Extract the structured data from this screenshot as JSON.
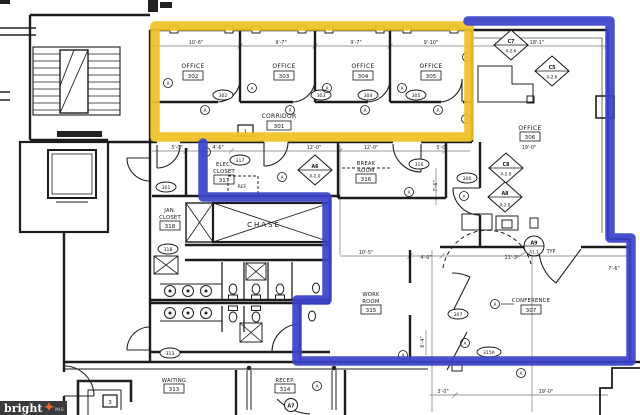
{
  "colors": {
    "highlight_yellow": "#EFC226",
    "highlight_blue": "#3B43C9",
    "ink": "#1c1c1c",
    "watermark_bg": "#3a3a3c",
    "watermark_accent": "#E8622D"
  },
  "watermark": {
    "brand": "bright",
    "suffix": "MLS"
  },
  "rooms": {
    "office_302": {
      "name": "OFFICE",
      "num": "302"
    },
    "office_303": {
      "name": "OFFICE",
      "num": "303"
    },
    "office_304": {
      "name": "OFFICE",
      "num": "304"
    },
    "office_305": {
      "name": "OFFICE",
      "num": "305"
    },
    "corridor_301": {
      "name": "CORRIDOR",
      "num": "301"
    },
    "office_306": {
      "name": "OFFICE",
      "num": "306"
    },
    "elec_closet_317": {
      "name1": "ELEC.",
      "name2": "CLOSET",
      "num": "317"
    },
    "break_room_316": {
      "name1": "BREAK",
      "name2": "ROOM",
      "num": "316"
    },
    "jan_closet_318": {
      "name1": "JAN.",
      "name2": "CLOSET",
      "num": "318"
    },
    "chase": {
      "name": "CHASE"
    },
    "work_room_315": {
      "name1": "WORK",
      "name2": "ROOM",
      "num": "315"
    },
    "conference_307": {
      "name": "CONFERENCE",
      "num": "307"
    },
    "waiting_313": {
      "name": "WAITING",
      "num": "313"
    },
    "recep_314": {
      "name": "RECEP.",
      "num": "314"
    }
  },
  "door_tags": {
    "t301": "301",
    "t302": "302",
    "t303": "303",
    "t304": "304",
    "t305": "305",
    "t306": "306",
    "t307": "307",
    "t313": "313",
    "t315a": "315A",
    "t316": "316",
    "t317": "317",
    "t318": "318"
  },
  "detail_markers": {
    "c7": {
      "code": "C7",
      "sheet": "A-2.6"
    },
    "c5": {
      "code": "C5",
      "sheet": "A-2.6"
    },
    "c8": {
      "code": "C8",
      "sheet": "A-2.0"
    },
    "a6": {
      "code": "A6",
      "sheet": "A-2.0"
    },
    "a8": {
      "code": "A8",
      "sheet": "A-2.0"
    },
    "a9": {
      "code": "A9",
      "sheet": "A1.1"
    },
    "a7": {
      "code": "A7"
    },
    "typ": "TYP"
  },
  "dims": {
    "d1": "10'-6\"",
    "d2": "9'-7\"",
    "d3": "9'-7\"",
    "d4": "9'-10\"",
    "d5": "18'-1\"",
    "d6": "5'-0\"",
    "d7": "4'-6\"",
    "d8": "12'-0\"",
    "d9": "12'-0\"",
    "d10": "5'-0\"",
    "d11": "19'-0\"",
    "d12": "10'-5\"",
    "d13": "4'-0\"",
    "d14": "21'-3\"",
    "d15": "7'-6\"",
    "d16": "7'-6\"",
    "d17": "6'-4\"",
    "d18": "3'-0\"",
    "d19": "19'-0\""
  },
  "keynotes": {
    "k1": "1",
    "k3": "3"
  },
  "annotations": {
    "ref": "REF",
    "circle_a": "A"
  }
}
